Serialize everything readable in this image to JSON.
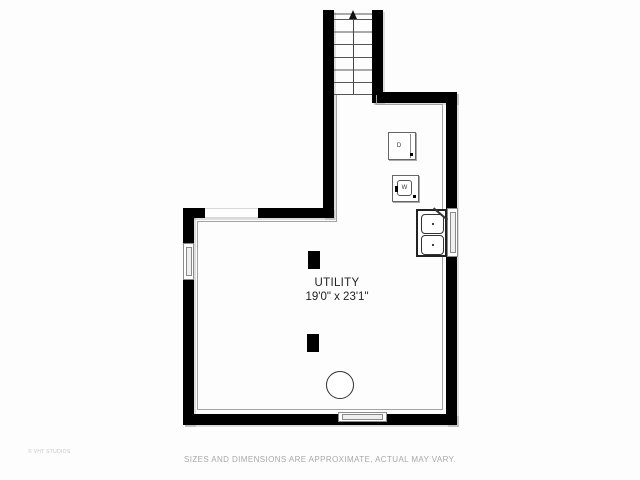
{
  "room": {
    "name": "UTILITY",
    "dimensions": "19'0\" x 23'1\""
  },
  "appliances": {
    "dryer_label": "D",
    "washer_label": "W",
    "sink": "double-basin-sink",
    "water_heater": "circle"
  },
  "stairs": {
    "direction_icon": "up-arrow",
    "tread_count": 7
  },
  "windows": {
    "left_wall": 1,
    "right_wall": 1,
    "bottom_wall": 1,
    "top_wall_opening": 1
  },
  "footer": {
    "disclaimer": "SIZES AND DIMENSIONS ARE APPROXIMATE, ACTUAL MAY VARY.",
    "watermark": "© VHT STUDIOS"
  },
  "colors": {
    "wall": "#000000",
    "room_outline": "#a3a3a3",
    "text": "#222222",
    "muted_text": "#a8a8a8",
    "background": "#fdfdfd"
  }
}
